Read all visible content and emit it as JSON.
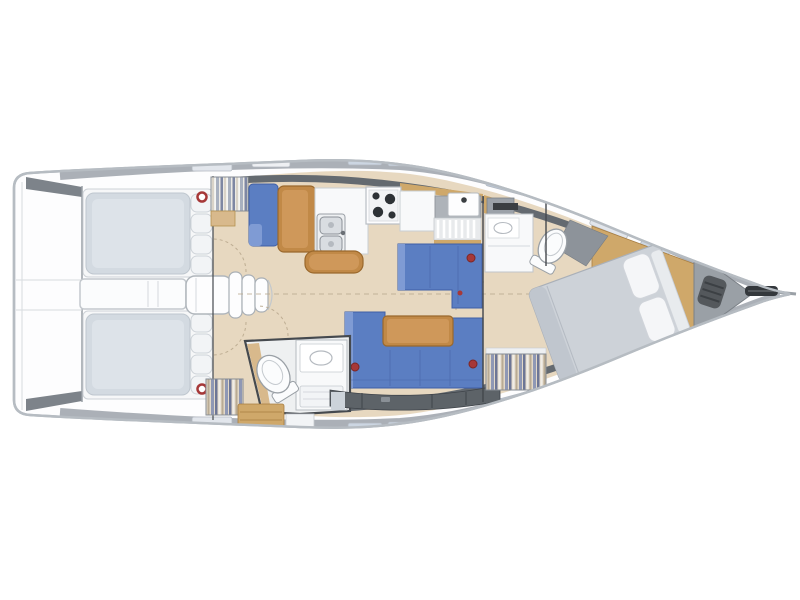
{
  "diagram": {
    "kind": "sailing-yacht-interior-floorplan",
    "view": "top-down",
    "bow_direction": "right"
  },
  "colors": {
    "hull_fill": "#fdfdfe",
    "hull_stroke": "#b6bcc2",
    "deck_band": "#a6acb3",
    "deck_dark": "#646a70",
    "locker": "#5d6368",
    "bulkhead": "#45494e",
    "floor": "#e7d8c0",
    "floor_line": "#b9a98e",
    "bench": "#f6f7f8",
    "cushion": "#d3dae1",
    "wood": "#c18947",
    "wood_dark": "#9a682c",
    "wood_light": "#d8b98c",
    "wood_pale": "#cfa86a",
    "upholstery": "#5b7ec2",
    "upholstery_dark": "#3f5fa6",
    "upholstery_light": "#7f9bd4",
    "bed": "#cdd2d8",
    "bed_shade": "#c0c6ce",
    "pillow": "#f5f6f8",
    "fixture": "#f8f9fa",
    "fixture_stroke": "#b5bac0",
    "steel": "#d9dde1",
    "shower_floor": "#8d939a",
    "anchor_locker": "#9aa0a6",
    "windlass": "#54585c",
    "accent_red": "#a63838",
    "hatch": "#ccd6e2",
    "hatch_light": "#e2e6ec",
    "window_tint": "#bdc9da"
  },
  "regions": [
    "swim-platform",
    "cockpit",
    "cockpit-bench-port",
    "cockpit-bench-starboard",
    "cockpit-table",
    "companionway-steps",
    "nav-seat",
    "chart-table",
    "galley",
    "stove",
    "galley-sink",
    "galley-bar",
    "dinette-settee",
    "salon-sofa",
    "salon-table",
    "aft-head",
    "aft-toilet",
    "forward-head",
    "forward-toilet",
    "forward-berth",
    "forward-wardrobe",
    "aft-wardrobe-port",
    "aft-wardrobe-starboard",
    "anchor-locker",
    "windlass",
    "bow-roller"
  ]
}
